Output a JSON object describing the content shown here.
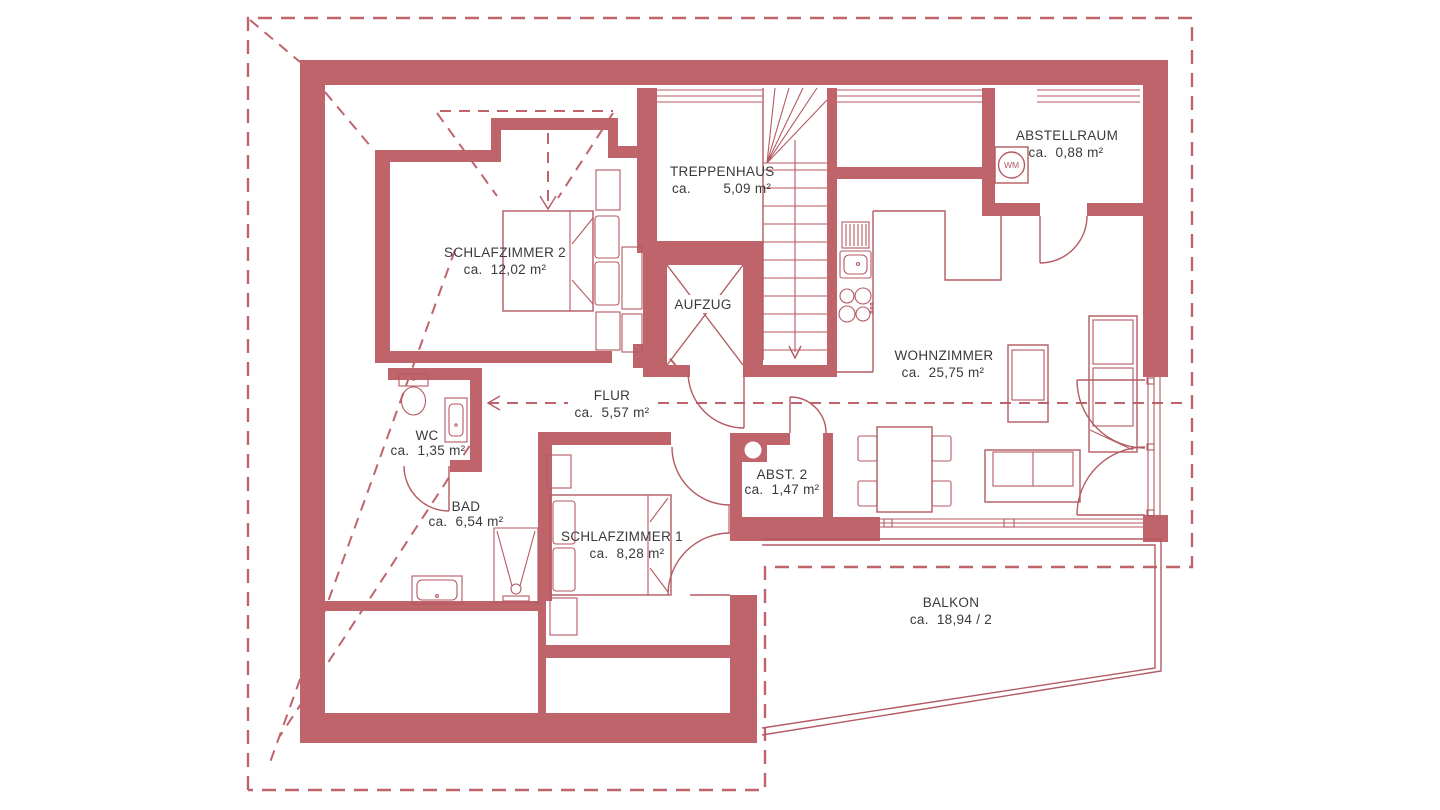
{
  "title": "Wohnung Grundriss Dachgeschoss",
  "colors": {
    "wall": "#c0646c",
    "line": "#b45a62",
    "text": "#3a3a3c",
    "background": "#ffffff"
  },
  "rooms": {
    "treppenhaus": {
      "name": "TREPPENHAUS",
      "area": "ca.        5,09 m²"
    },
    "abstellraum": {
      "name": "ABSTELLRAUM",
      "area": "ca.  0,88 m²"
    },
    "schlafzimmer2": {
      "name": "SCHLAFZIMMER 2",
      "area": "ca.  12,02 m²"
    },
    "aufzug": {
      "name": "AUFZUG"
    },
    "wohnzimmer": {
      "name": "WOHNZIMMER",
      "area": "ca.  25,75 m²"
    },
    "flur": {
      "name": "FLUR",
      "area": "ca.  5,57 m²"
    },
    "wc": {
      "name": "WC",
      "area": "ca.  1,35 m²"
    },
    "abst2": {
      "name": "ABST. 2",
      "area": "ca.  1,47 m²"
    },
    "bad": {
      "name": "BAD",
      "area": "ca.  6,54 m²"
    },
    "schlafzimmer1": {
      "name": "SCHLAFZIMMER 1",
      "area": "ca.  8,28 m²"
    },
    "balkon": {
      "name": "BALKON",
      "area": "ca.  18,94 / 2"
    }
  },
  "icons": {
    "washing_machine_label": "WM"
  }
}
